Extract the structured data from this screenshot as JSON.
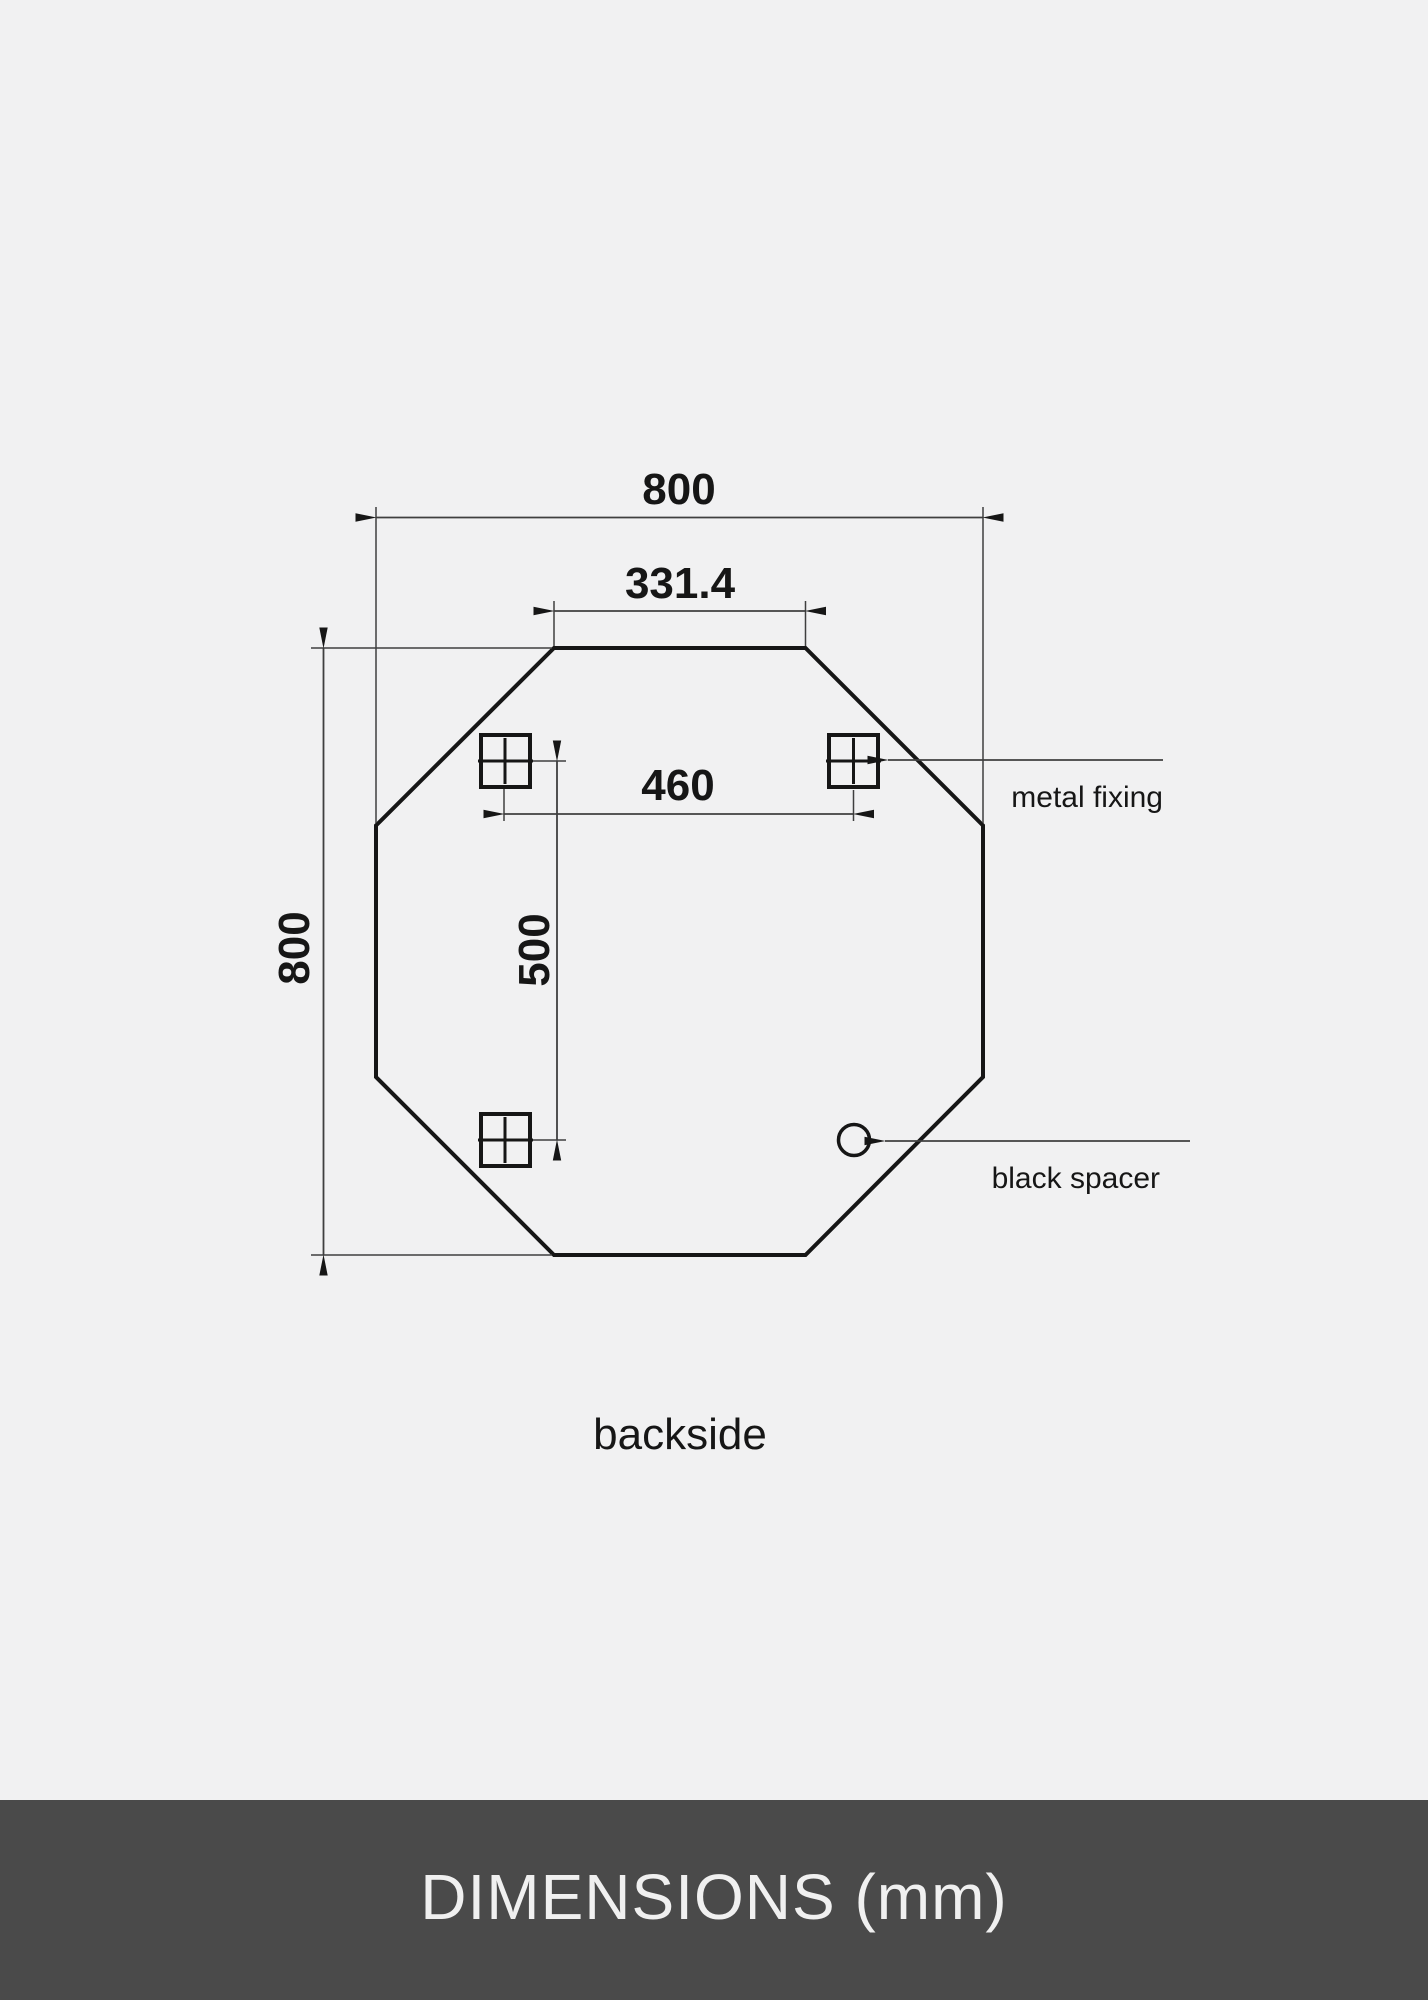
{
  "page": {
    "background": "#f1f1f2"
  },
  "diagram": {
    "caption": "backside",
    "dimensions": {
      "overall_width": "800",
      "top_edge": "331.4",
      "fixing_spacing_horizontal": "460",
      "fixing_spacing_vertical": "500",
      "overall_height": "800"
    },
    "callouts": {
      "metal_fixing": "metal fixing",
      "black_spacer": "black spacer"
    },
    "icons": {
      "metal_fixing_marker": "square-with-cross",
      "black_spacer_marker": "circle"
    },
    "colors": {
      "outline": "#161616",
      "thin_line": "#3f3f3f"
    }
  },
  "footer": {
    "title": "DIMENSIONS (mm)",
    "background": "#4a4a4a",
    "text_color": "#f0f0f0"
  }
}
